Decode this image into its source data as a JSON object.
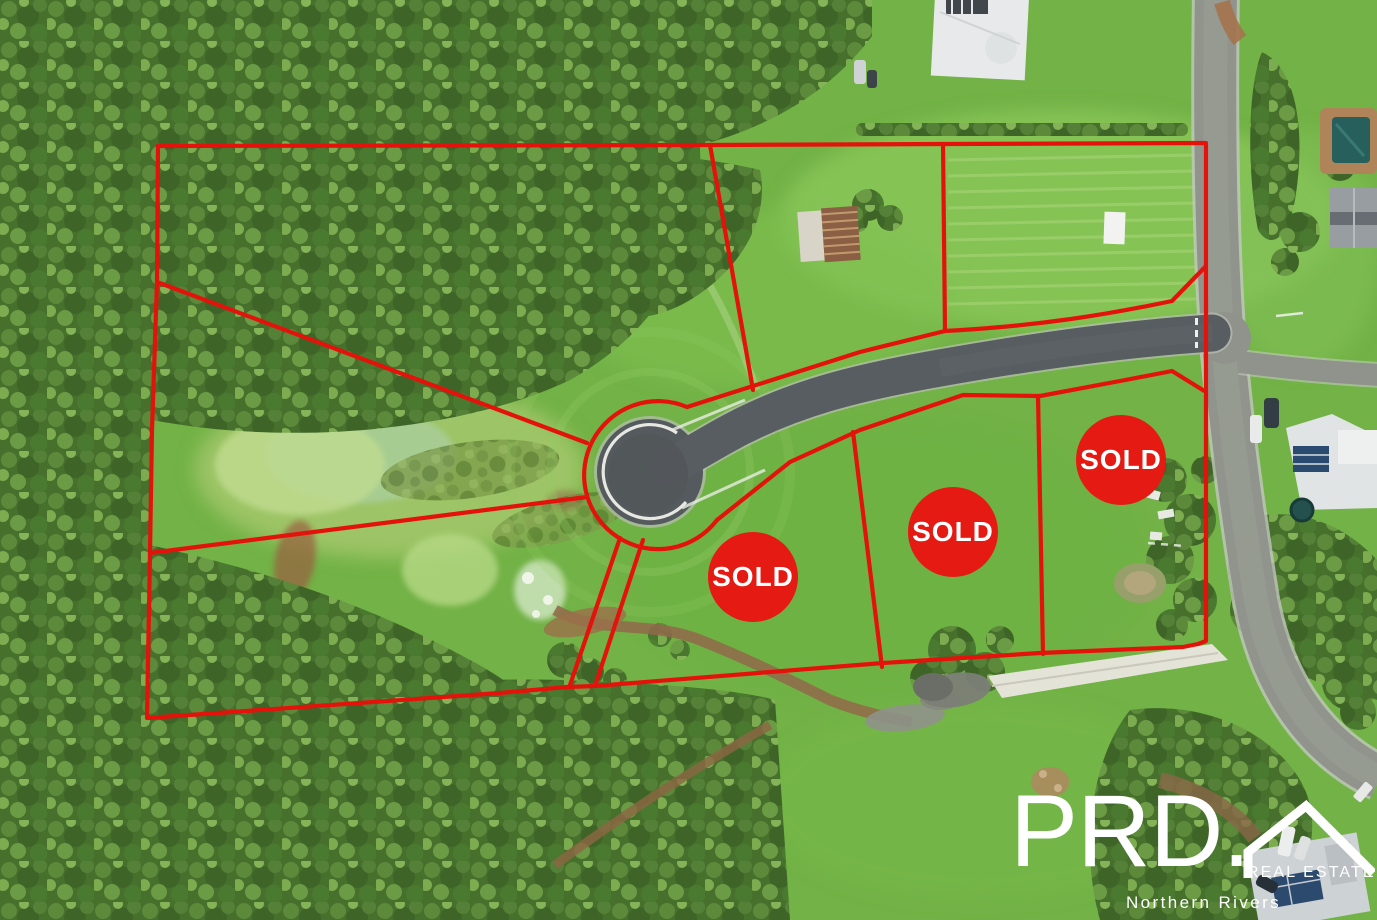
{
  "scene": {
    "title": "Aerial drone photo of a rural residential land subdivision outlined in red",
    "kind": "real-estate aerial photo"
  },
  "lots": {
    "sold_badges": [
      {
        "label": "SOLD"
      },
      {
        "label": "SOLD"
      },
      {
        "label": "SOLD"
      }
    ]
  },
  "watermark": {
    "brand": "PRD.",
    "division": "REAL ESTATE",
    "region": "Northern Rivers",
    "icon": "roof-icon"
  },
  "colors": {
    "boundary_red": "#e3130b",
    "sold_red": "#e51a12",
    "sold_text": "#ffffff",
    "watermark_text": "#ffffff",
    "grass_green": "#72b246",
    "forest_green": "#46702c",
    "road_asphalt": "#585d62",
    "street_gray": "#90948d",
    "concrete_ramp": "#e4e3d8",
    "dirt_brown": "#92684a",
    "pool_teal": "#275f5c",
    "solar_panel_blue": "#2b4a70"
  }
}
